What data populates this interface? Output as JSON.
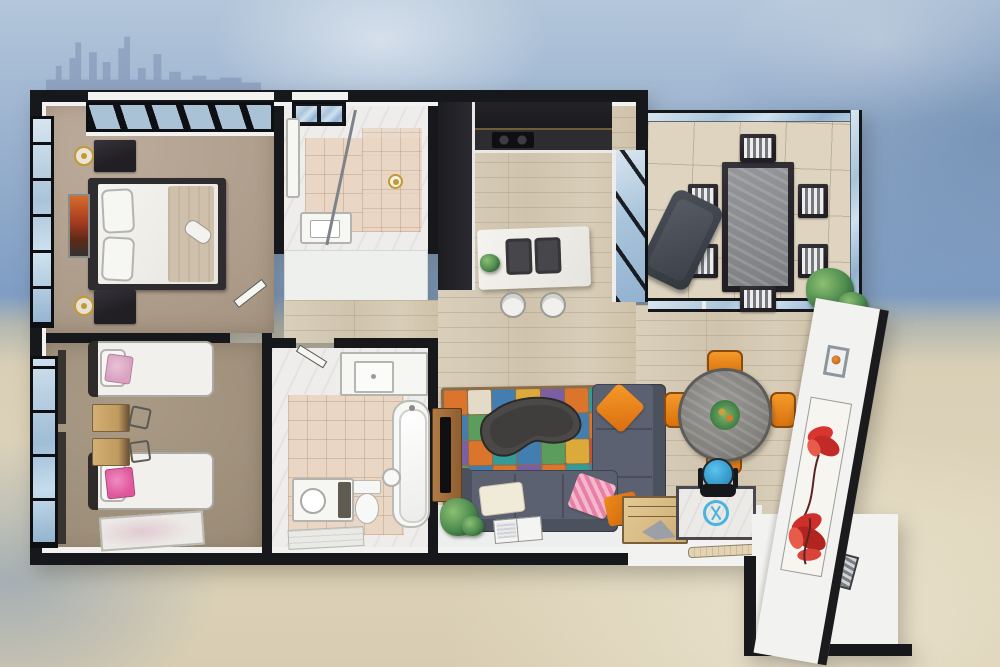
{
  "scene": {
    "type": "3d-floor-plan-illustration",
    "description": "Top-down 3D dollhouse render of a two-bedroom seaside apartment floor plan over a watercolor beach background",
    "width_px": 1000,
    "height_px": 667
  },
  "background": {
    "sky": "watercolor blue sky",
    "skyline": "faded city skyline silhouette",
    "sea": "ocean water band",
    "beach": "sand wash"
  },
  "palette": {
    "wall": "#17181b",
    "wallFace": "#f2f2f0",
    "skyline": "#8496b8",
    "carpetMaster": "#b4a393",
    "carpetKids": "#a29280",
    "wood": "#d6cbb7",
    "marble": "#efedeb",
    "tile": "#e9d6c5",
    "balconyTile": "#ded4c0",
    "glass": "#b7cfe2",
    "cabinet": "#26262b",
    "counter": "#f0efeb",
    "sinkDark": "#47474b",
    "sofa": "#5b6170",
    "sofaDark": "#4a505e",
    "orange": "#ea8320",
    "pink": "#ec93ae",
    "cream": "#efe8da",
    "tableGray": "#8f8d88",
    "chairOrange": "#ef8f1d",
    "deskWood": "#c9a56c",
    "woodFurniture": "#a8713f",
    "dark": "#2e2c2e",
    "blue": "#3fa9dc",
    "red": "#d8352f",
    "green": "#3f7d46",
    "gold": "#c19a33",
    "white": "#f7f7f4"
  },
  "rooms": [
    {
      "id": "master-bedroom",
      "name": "Master Bedroom",
      "furniture": [
        "double bed",
        "pillow x2",
        "throw blanket",
        "nightstand x2",
        "table lamp x2",
        "wall art",
        "skylight window",
        "grid side window"
      ]
    },
    {
      "id": "ensuite-bathroom",
      "name": "Ensuite Bathroom",
      "furniture": [
        "vanity sink",
        "mirror cabinet",
        "glass shower screen",
        "gold floor lamp",
        "skylight panels"
      ]
    },
    {
      "id": "hallway",
      "name": "Hallway",
      "furniture": [
        "open door x2"
      ]
    },
    {
      "id": "kitchen",
      "name": "Kitchen",
      "furniture": [
        "dark L-shaped cabinets",
        "cooktop",
        "island with double sink",
        "bar stool x2",
        "potted plant",
        "window wall to balcony"
      ]
    },
    {
      "id": "balcony",
      "name": "Balcony",
      "furniture": [
        "outdoor dining table",
        "striped dining chair x6",
        "lounge chair",
        "shrub planter",
        "glass balustrade",
        "sliding glass doors"
      ]
    },
    {
      "id": "kids-bedroom",
      "name": "Kids Bedroom",
      "furniture": [
        "single bed x2",
        "pink cushion x2",
        "study desk x2",
        "desk chair x2",
        "rug",
        "grid window"
      ]
    },
    {
      "id": "bathroom",
      "name": "Main Bathroom",
      "furniture": [
        "bathtub",
        "toilet",
        "bidet",
        "vanity with round basin",
        "counter with square sink",
        "step shelf"
      ]
    },
    {
      "id": "living-room",
      "name": "Living / Dining Room",
      "furniture": [
        "sectional sofa",
        "cushion x4",
        "patchwork rug",
        "kidney coffee table",
        "TV console",
        "TV",
        "floor plant",
        "open magazine",
        "round dining table",
        "orange chair x4",
        "centerpiece plant"
      ]
    },
    {
      "id": "study-corner",
      "name": "Study Corner",
      "furniture": [
        "white desk",
        "monitor with blue logo",
        "keyboard",
        "blue office chair",
        "wooden document organizer"
      ]
    },
    {
      "id": "entry",
      "name": "Entry Walkway",
      "furniture": [
        "striped doormat"
      ]
    },
    {
      "id": "east-wall",
      "name": "East Wall",
      "furniture": [
        "small framed art",
        "red flower canvas"
      ]
    }
  ],
  "living_room": {
    "rug": {
      "style": "patchwork",
      "cols": 8,
      "rows": 5,
      "colors": {
        "o": "#e0762a",
        "b": "#3f7fb5",
        "g": "#57a05e",
        "p": "#7b5ea8",
        "t": "#2f9e9b",
        "r": "#c94f35",
        "y": "#dfae3a",
        "c": "#e8e0ce"
      },
      "pattern": [
        "ocbypotg",
        "bgorcbop",
        "potbgyrb",
        "gbopotbo",
        "yrgbcpgt"
      ]
    }
  }
}
